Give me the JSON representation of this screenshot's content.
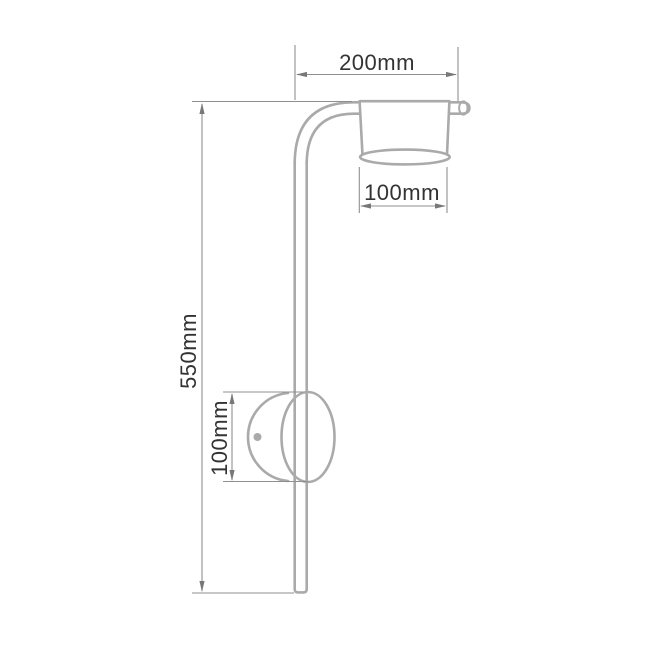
{
  "drawing": {
    "name": "wall-lamp-dimension-diagram",
    "labels": {
      "arm_length": "200mm",
      "pole_height": "550mm",
      "shade_diameter": "100mm",
      "mount_height": "100mm"
    },
    "colors": {
      "fixture_outline": "#aaaaaa",
      "dimension_line": "#8f8f8f",
      "arrowhead": "#787878",
      "label_text": "#333333",
      "background": "#ffffff"
    }
  }
}
